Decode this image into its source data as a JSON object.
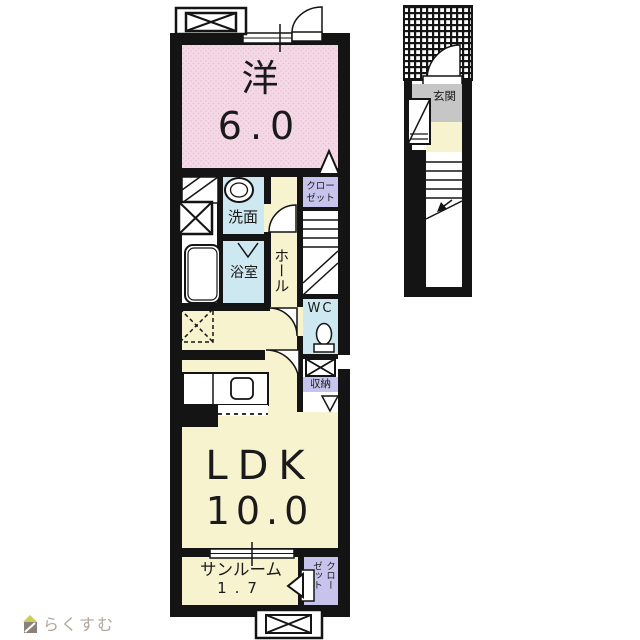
{
  "colors": {
    "wall": "#141414",
    "cream": "#f8f3cf",
    "pink": "#f4d8e6",
    "blue": "#cde8f0",
    "purple": "#c6c4ec",
    "gray": "#c6c6c6",
    "white": "#ffffff",
    "logo_text": "#b3a79c",
    "logo_roof": "#c9d050",
    "logo_body": "#8b8178"
  },
  "rooms": {
    "western": {
      "name": "洋",
      "size": "6.0"
    },
    "washroom": {
      "name": "洗面"
    },
    "bathroom": {
      "name": "浴室"
    },
    "hall": {
      "name": "ホール"
    },
    "closet_upper": {
      "name": "クロー\nゼット"
    },
    "wc": {
      "name": "WC"
    },
    "storage": {
      "name": "収納"
    },
    "ldk": {
      "name": "LDK",
      "size": "10.0"
    },
    "sunroom": {
      "name": "サンルーム",
      "size": "1.7"
    },
    "closet_sunroom": {
      "name": "クロー\nゼット"
    },
    "entrance": {
      "name": "玄関"
    }
  },
  "branding": {
    "logo_text": "らくすむ"
  }
}
